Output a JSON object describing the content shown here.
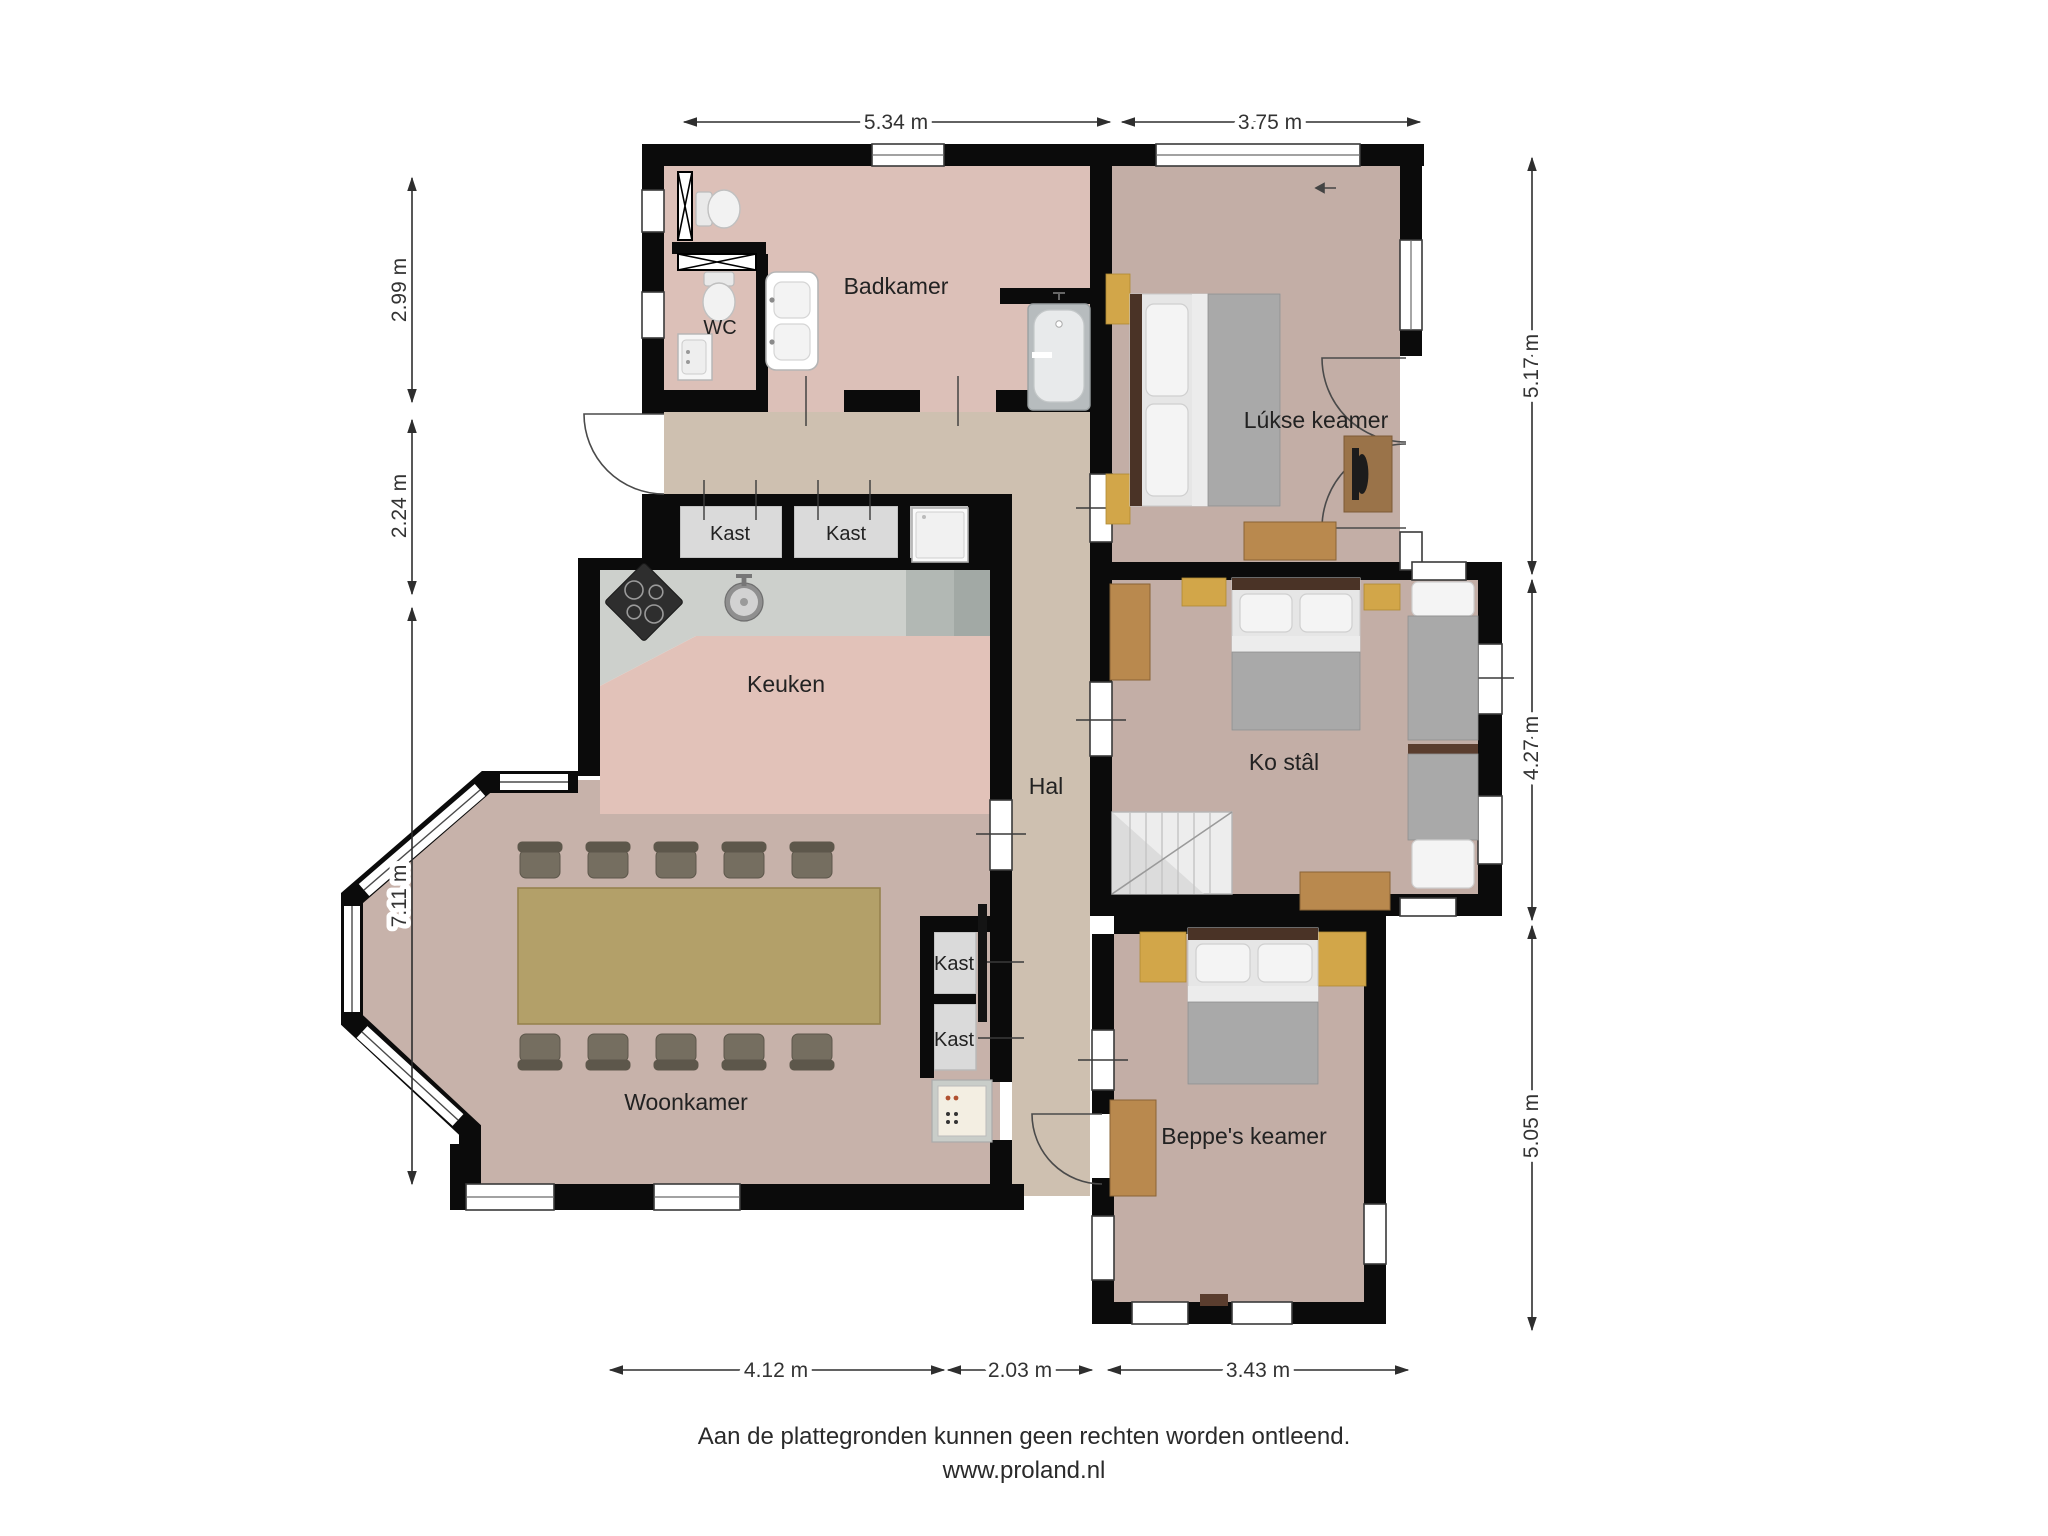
{
  "rooms": {
    "badkamer": "Badkamer",
    "wc": "WC",
    "kast1": "Kast",
    "kast2": "Kast",
    "keuken": "Keuken",
    "hal": "Hal",
    "lukse_keamer": "Lúkse keamer",
    "ko_stal": "Ko stâl",
    "woonkamer": "Woonkamer",
    "kast3": "Kast",
    "kast4": "Kast",
    "beppes_keamer": "Beppe's keamer"
  },
  "dimensions": {
    "top": [
      {
        "label": "5.34 m"
      },
      {
        "label": "3.75 m"
      }
    ],
    "left": [
      {
        "label": "2.99 m"
      },
      {
        "label": "2.24 m"
      },
      {
        "label": "7.11 m"
      }
    ],
    "right": [
      {
        "label": "5.17 m"
      },
      {
        "label": "4.27 m"
      },
      {
        "label": "5.05 m"
      }
    ],
    "bottom": [
      {
        "label": "4.12 m"
      },
      {
        "label": "2.03 m"
      },
      {
        "label": "3.43 m"
      }
    ]
  },
  "footer": {
    "line1": "Aan de plattegronden kunnen geen rechten worden ontleend.",
    "line2": "www.proland.nl"
  },
  "colors": {
    "wall": "#0b0b0b",
    "floor-bath": "#dcc0b8",
    "floor-kitchen": "#e2c2b9",
    "floor-hall": "#cec0b0",
    "floor-bedroom": "#c3aea6",
    "floor-living": "#c7b2aa",
    "floor-closet": "#dadada",
    "counter": "#cdd0cc",
    "counter-dark": "#a2a9a5",
    "wood": "#b9894e",
    "gold": "#d2a649",
    "bed-blanket": "#a9a9a9",
    "headboard": "#4a3326",
    "text": "#222222",
    "dim": "#333333"
  }
}
